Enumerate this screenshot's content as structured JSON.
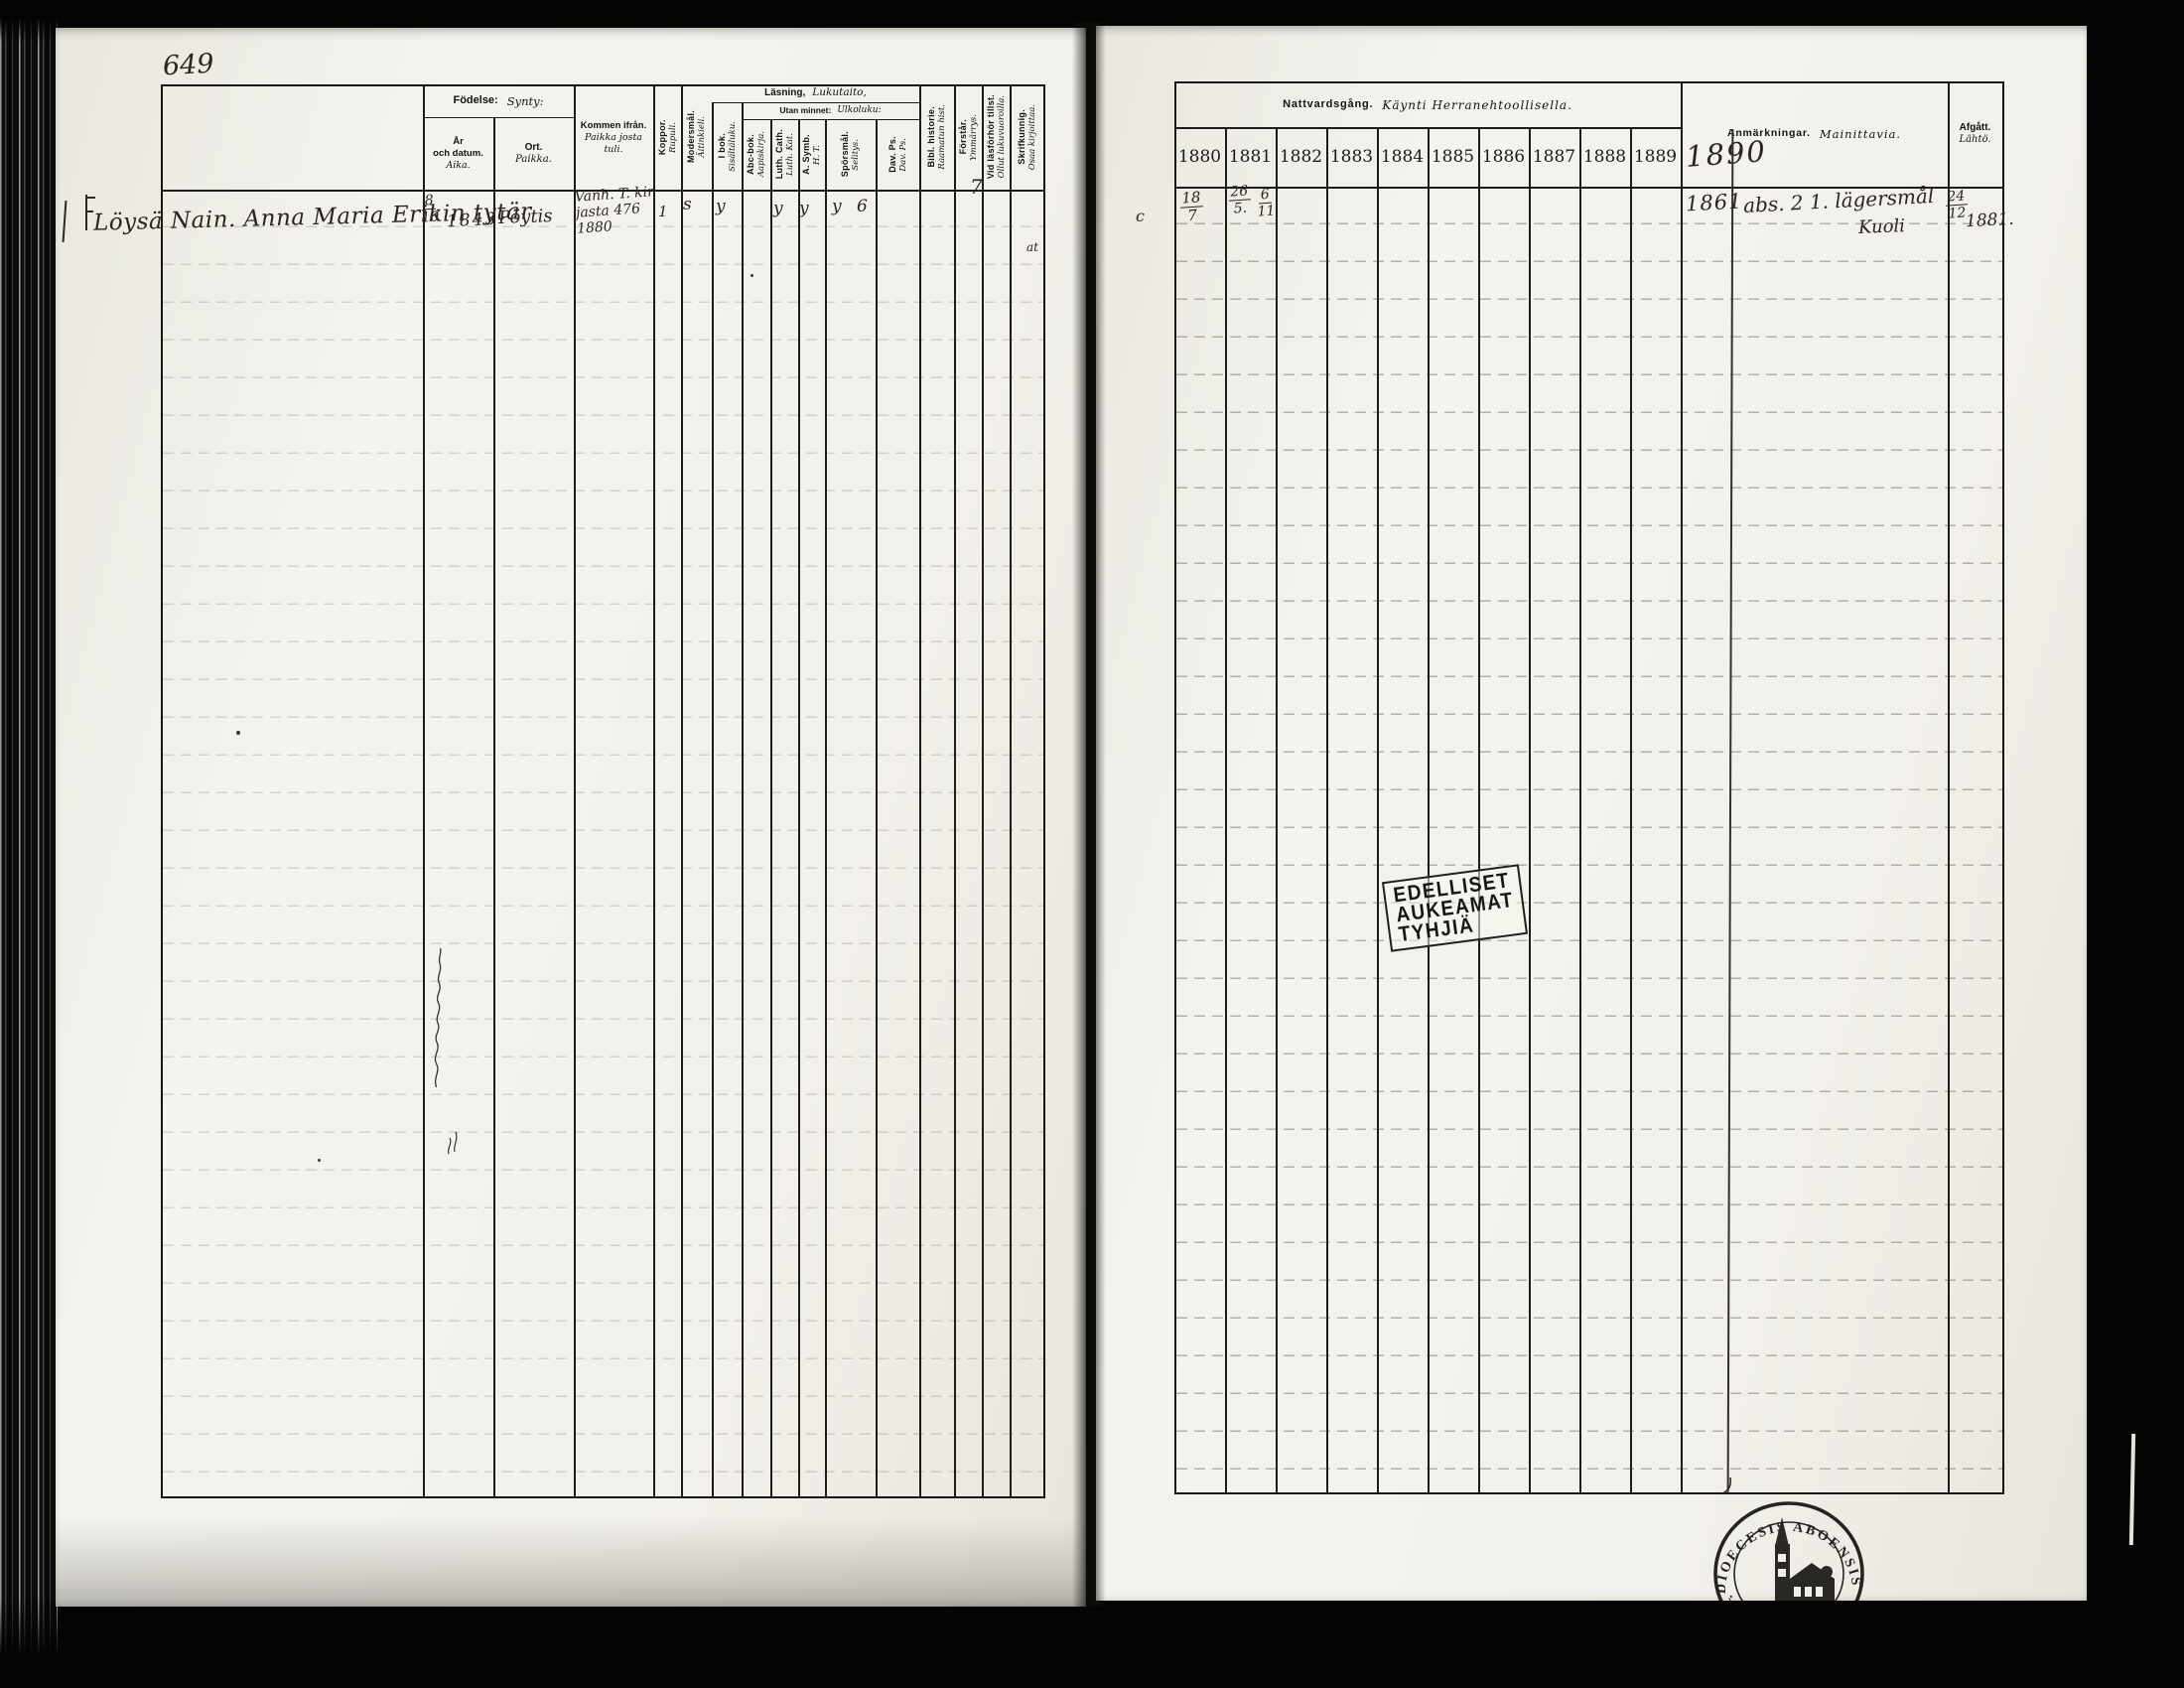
{
  "meta": {
    "page_number": "649"
  },
  "headers": {
    "fodelse_sv": "Födelse:",
    "fodelse_fi": "Synty:",
    "lasning_sv": "Läsning,",
    "lasning_fi": "Lukutaito,",
    "utan_sv": "Utan minnet:",
    "utan_fi": "Ulkoluku:",
    "nattvard_sv": "Nattvardsgång.",
    "nattvard_fi": "Käynti Herranehtoollisella.",
    "anm_sv": "Anmärkningar.",
    "anm_fi": "Mainittavia.",
    "afgatt_sv": "Afgått.",
    "afgatt_fi": "Lähtö."
  },
  "columns": {
    "ar_sv1": "År",
    "ar_sv2": "och datum.",
    "ar_fi": "Aika.",
    "ort_sv": "Ort.",
    "ort_fi": "Paikka.",
    "kommen_sv": "Kommen ifrån.",
    "kommen_fi1": "Paikka josta",
    "kommen_fi2": "tuli.",
    "koppor_sv": "Koppor.",
    "koppor_fi": "Rupuli.",
    "modersmal_sv": "Modersmål.",
    "modersmal_fi": "Äitinkieli.",
    "ibok_sv": "I bok.",
    "ibok_fi": "Sisältäluku.",
    "abc_sv": "Abc-bok.",
    "abc_fi": "Aapiskirja.",
    "luth_sv": "Luth. Cath.",
    "luth_fi": "Luth. Kat.",
    "symb_sv": "A. Symb.",
    "symb_fi": "H. T.",
    "sporsmal_sv": "Spörsmål.",
    "sporsmal_fi": "Selitys.",
    "davps_sv": "Dav. Ps.",
    "davps_fi": "Dav. Ps.",
    "bibl_sv": "Bibl. historie.",
    "bibl_fi": "Raamatun hist.",
    "forstar_sv": "Förstår.",
    "forstar_fi": "Ymmärrys.",
    "vid_sv": "Vid läsförhör tillst.",
    "vid_fi": "Ollut lukuvuoroilla.",
    "skrif_sv": "Skrifkunnig.",
    "skrif_fi": "Osaa kirjoittaa."
  },
  "years": [
    "1880",
    "1881",
    "1882",
    "1883",
    "1884",
    "1885",
    "1886",
    "1887",
    "1888",
    "1889"
  ],
  "year_handwritten": "1890",
  "entry": {
    "name": "Löysä Nain. Anna Maria Erikin tytär",
    "birth_day": "8",
    "birth_month": "10",
    "birth_year": "1843",
    "birth_place": "Pöytis",
    "came_from_1": "Vanh. T. kir",
    "came_from_2": "jasta  476",
    "came_from_3": "1880",
    "mark_koppor": "1",
    "mark_modersmal": "s",
    "mark_ibok": "y",
    "mark_luth": "y",
    "mark_symb": "y",
    "mark_sporsmal": "y 6",
    "mark_forstar": "7",
    "mark_skrif": "at",
    "margin_note": "c",
    "comm_1880_day": "18",
    "comm_1880_month": "7",
    "comm_1881_a_day": "26",
    "comm_1881_a_month": "5.",
    "comm_1881_b_day": "6",
    "comm_1881_b_month": "11",
    "remark_year": "1861",
    "remark_text": "abs. 2 1. lägersmål",
    "remark_text2": "Kuoli",
    "afgatt_day": "24",
    "afgatt_month": "12",
    "afgatt_year": "1881."
  },
  "stamps": {
    "note_line1": "EDELLISET",
    "note_line2": "AUKEAMAT",
    "note_line3": "TYHJIÄ",
    "seal_arc": "DIOECESIS ABOENSIS.",
    "seal_left": "NL.",
    "seal_right": "MA"
  }
}
